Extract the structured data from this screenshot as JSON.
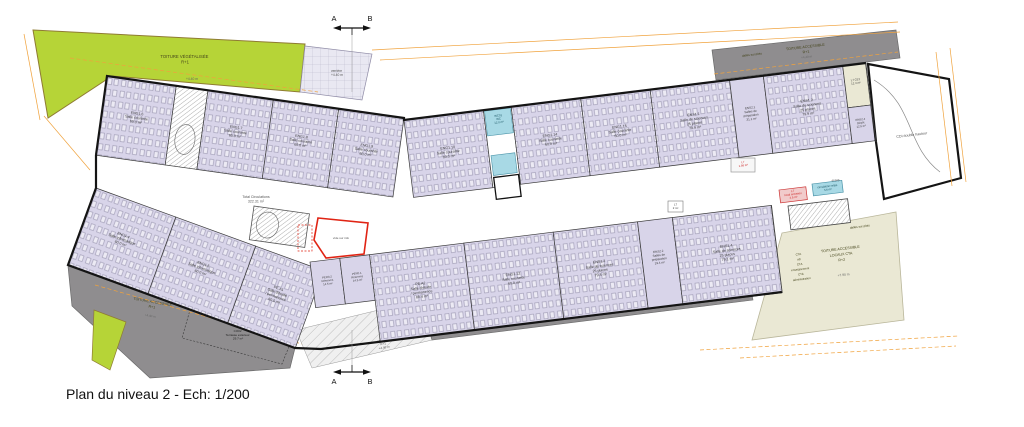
{
  "caption": "Plan du niveau 2 - Ech: 1/200",
  "marker": {
    "left": "A",
    "right": "B"
  },
  "circulation": {
    "l1": "Total Circulations",
    "l2": "322.31 m²"
  },
  "cdi_label": "CDI double hauteur",
  "roofs": {
    "green": {
      "l1": "TOITURE VÉGÉTALISÉE",
      "l2": "R+1",
      "level": "+4.40 m"
    },
    "gray_tr": {
      "l1": "TOITURE ACCESSIBLE",
      "l2": "R+1",
      "level": "+4.40 m",
      "note": "dalles sur plots"
    },
    "gray_bl": {
      "l1": "TOITURE ACCESSIBLE",
      "l2": "R+1",
      "level": "+4.40 m"
    },
    "terrace": {
      "id": "CO02",
      "name": "Terrasse extérieur",
      "area": "29.7 m²"
    },
    "verriere": {
      "name": "verrière",
      "l2": "R+1",
      "level": "+4.40 m"
    },
    "cta": {
      "l1": "TOITURE ACCESSIBLE",
      "l2": "LOCAUX CTA",
      "l3": "R+2",
      "level": "+7.90 m",
      "note": "dalles sur plots",
      "items": [
        "CTA",
        "cdi",
        "CTA",
        "enseignement",
        "CTA",
        "administration"
      ]
    }
  },
  "boxes": {
    "wc": {
      "id": "WC01",
      "name": "WC",
      "area": "12.0 m²"
    },
    "l7_small": {
      "id": "L7",
      "area": "1.98 m²"
    },
    "l7_tiny": {
      "id": "L7",
      "area": "2 m²"
    },
    "entretien": {
      "id": "L7",
      "name": "local entretien",
      "area": "4.5 m²"
    },
    "relais": {
      "name": "circulation relais",
      "area": "3.6 m²"
    },
    "degag": "dégag.",
    "vide": "vide sur info"
  },
  "rooms": [
    {
      "id": "ENG1.6",
      "name": "Salle courante",
      "area": "60.0 m²"
    },
    {
      "id": "ENG1.7",
      "name": "Salle courante",
      "area": "60.0 m²"
    },
    {
      "id": "ENG1.8",
      "name": "Salle courante",
      "area": "60.0 m²"
    },
    {
      "id": "ENG1.9",
      "name": "Salle courante",
      "area": "60.0 m²"
    },
    {
      "id": "ENG1.10",
      "name": "Salle courante",
      "area": "60.0 m²"
    },
    {
      "id": "ENG1.14",
      "name": "Salle courante",
      "area": "60.0 m²"
    },
    {
      "id": "ENG1.15",
      "name": "Salle courante",
      "area": "60.0 m²"
    },
    {
      "id": "ENS1.1",
      "name": "Salle de sciences",
      "name2": "25 places",
      "area": "79.9 m²"
    },
    {
      "id": "ENS2.1",
      "name": "Salles de",
      "name2": "préparation",
      "area": "31.1 m²"
    },
    {
      "id": "ENS1.2",
      "name": "Salle de sciences",
      "name2": "25 places",
      "area": "79.9 m²"
    },
    {
      "id": "L7 CE3",
      "name": "",
      "area": "12.3 m²"
    },
    {
      "id": "ENS2.4",
      "name": "Dépôt",
      "area": "12.5 m²"
    },
    {
      "id": "ENG1.4",
      "name": "Salle informatique",
      "area": "60.0 m²"
    },
    {
      "id": "ENG1.5",
      "name": "Salle informatique",
      "area": "60.0 m²"
    },
    {
      "id": "PE.A1",
      "name": "Salle d'étude",
      "name2": "/ permanence",
      "area": "60.0 m²"
    },
    {
      "id": "PER0.2",
      "name": "Réserves",
      "area": "14.5 m²"
    },
    {
      "id": "PER0.1",
      "name": "Réserves",
      "area": "14.5 m²"
    },
    {
      "id": "PE.A2",
      "name": "Salle d'étude",
      "name2": "/ permanence",
      "area": "80.4 m²"
    },
    {
      "id": "ENG1.12",
      "name": "Salle courante",
      "area": "60.0 m²"
    },
    {
      "id": "ENS1.3",
      "name": "Salle de sciences",
      "name2": "25 places",
      "area": "79.4 m²"
    },
    {
      "id": "ENS2.2",
      "name": "Salles de",
      "name2": "préparation",
      "area": "19.4 m²"
    },
    {
      "id": "ENS1.4",
      "name": "Salle de sciences",
      "name2": "25 places",
      "area": "79.1 m²"
    }
  ],
  "colors": {
    "room_fill": "#d8d4e9",
    "green_roof": "#b6d437",
    "gray_roof": "#8f8d8f",
    "beige": "#eae8d4",
    "cyan": "#a8d9e5",
    "pink": "#f1cbcb",
    "red_accent": "#e02414",
    "orange_dim": "#f0a23c",
    "wall": "#141414"
  }
}
